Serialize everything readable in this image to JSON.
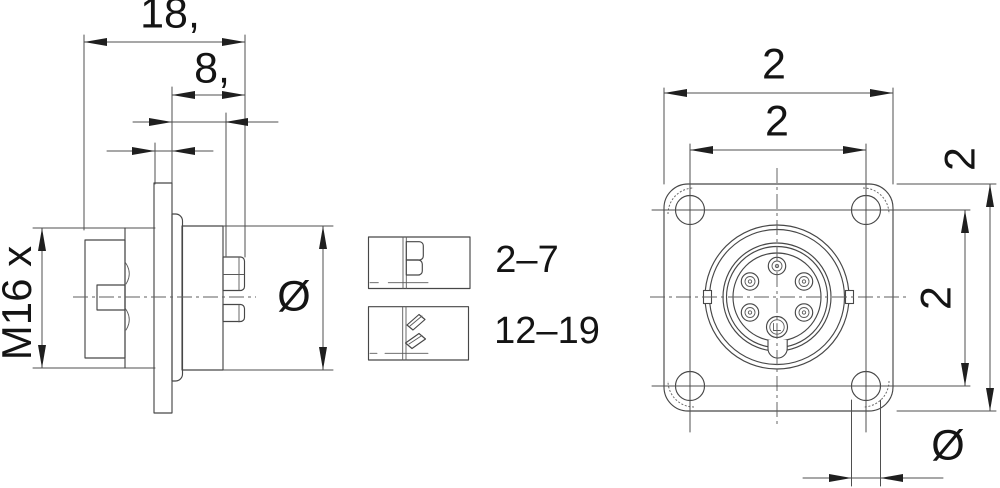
{
  "colors": {
    "background": "#ffffff",
    "line": "#474747",
    "dimension_text": "#141414"
  },
  "side_view": {
    "dim_overall_length": "18,",
    "dim_rear_length": "8,",
    "dim_thread": "M16 x",
    "dim_body_diameter": "Ø"
  },
  "front_view": {
    "dim_flange_width": "2",
    "dim_hole_spacing_horizontal": "2",
    "dim_flange_height": "2",
    "dim_hole_spacing_vertical": "2",
    "dim_mounting_hole_diameter": "Ø"
  },
  "contact_details": {
    "straight_contacts_label": "2–7",
    "angled_contacts_label": "12–19"
  }
}
